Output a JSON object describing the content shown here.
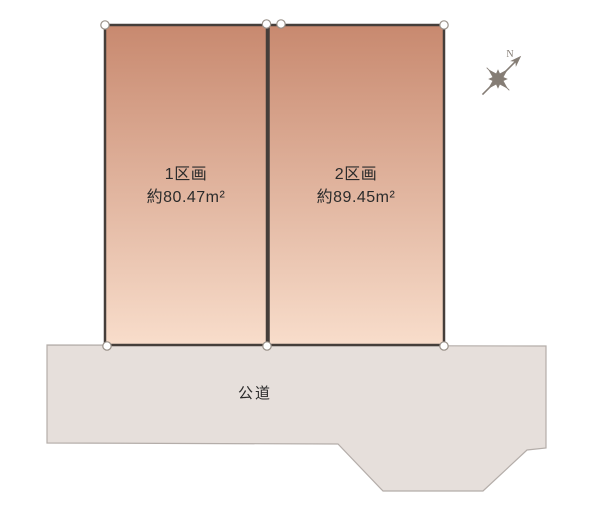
{
  "diagram": {
    "title": "land-plot-layout",
    "plots": [
      {
        "name": "1区画",
        "area": "約80.47m²"
      },
      {
        "name": "2区画",
        "area": "約89.45m²"
      }
    ],
    "road_label": "公道",
    "compass_label": "N",
    "colors": {
      "background": "#ffffff",
      "plot_top": "#c8896f",
      "plot_bottom": "#f8ddcb",
      "plot_border": "#453e3a",
      "road_fill": "#e6dfdb",
      "road_border": "#b4ada9",
      "marker_fill": "#ffffff",
      "marker_stroke": "#999189",
      "compass": "#857d75",
      "text": "#2b2b2b"
    }
  }
}
